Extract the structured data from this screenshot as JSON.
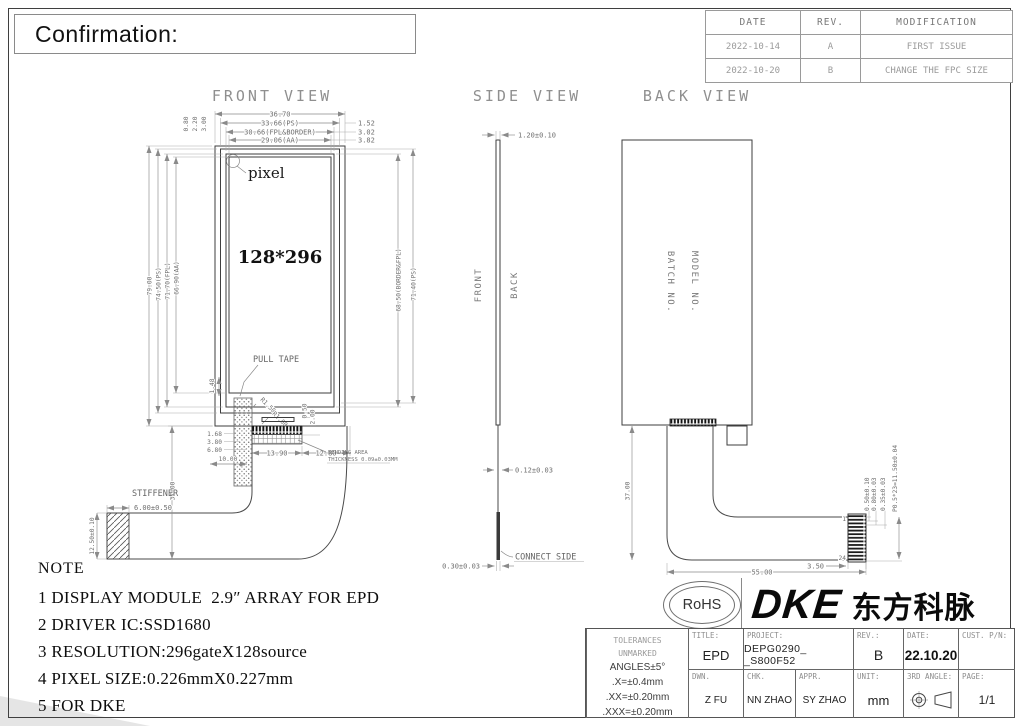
{
  "confirmation": {
    "label": "Confirmation:"
  },
  "revision": {
    "headers": [
      "DATE",
      "REV.",
      "MODIFICATION"
    ],
    "rows": [
      [
        "2022-10-14",
        "A",
        "FIRST ISSUE"
      ],
      [
        "2022-10-20",
        "B",
        "CHANGE THE FPC SIZE"
      ]
    ]
  },
  "front": {
    "title": "FRONT VIEW",
    "labels": {
      "pixel": "pixel",
      "resolution": "128*296",
      "pull_tape": "PULL TAPE",
      "stiffener": "STIFFENER",
      "bending_1": "BENDING AREA",
      "bending_2": "THICKNESS 0.09±0.03MM"
    },
    "dims": {
      "width_overall": "36.70",
      "width_ps": "33.66(PS)",
      "width_fpl": "30.66(FPL&BORDER)",
      "width_aa": "29.06(AA)",
      "right_gap_ps": "1.52",
      "right_gap_fpl": "3.02",
      "right_gap_aa": "3.82",
      "top_gap_ps": "0.80",
      "top_gap_fpl": "2.20",
      "top_gap_aa": "3.00",
      "height_overall": "79.00",
      "height_ps": "74.50(PS)",
      "height_fpl": "71.70(FPL)",
      "height_aa": "66.90(AA)",
      "height_border_fpl": "68.50(BORDER&FPL)",
      "height_ps_right": "71.40(PS)",
      "tape_gap": "1.48",
      "stack_1": "1.68",
      "stack_2": "3.80",
      "stack_3": "6.80",
      "tape_width": "10.00",
      "conn_width": "13.90",
      "conn_right": "12.80",
      "conn_h1": "0.50",
      "conn_h2": "2.00",
      "radius_1": "R1.50",
      "radius_2": "R1.00",
      "fpc_drop": "37.00",
      "stiffener_w": "6.00±0.50",
      "stiffener_h": "12.50±0.10"
    }
  },
  "side": {
    "title": "SIDE VIEW",
    "front_label": "FRONT",
    "back_label": "BACK",
    "connect_side": "CONNECT SIDE",
    "dims": {
      "thickness": "1.20±0.10",
      "fpc_thickness": "0.12±0.03",
      "connector_thickness": "0.30±0.03"
    }
  },
  "back": {
    "title": "BACK VIEW",
    "model_no": "MODEL NO.",
    "batch_no": "BATCH NO.",
    "pin_first": "1",
    "pin_last": "24",
    "dims": {
      "fpc_drop": "37.00",
      "fpc_length": "55.00",
      "connector_offset": "3.50",
      "pin_dim_1": "0.50±0.10",
      "pin_dim_2": "0.80±0.03",
      "pin_dim_3": "0.35±0.03",
      "pin_pitch": "P0.5*23=11.50±0.04"
    }
  },
  "note": {
    "heading": "NOTE",
    "lines": [
      "1 DISPLAY MODULE  2.9″ ARRAY FOR EPD",
      "2 DRIVER IC:SSD1680",
      "3 RESOLUTION:296gateX128source",
      "4 PIXEL SIZE:0.226mmX0.227mm",
      "5 FOR DKE"
    ]
  },
  "logos": {
    "rohs": "RoHS",
    "dke": "DKE",
    "dke_cn": "东方科脉"
  },
  "title_block": {
    "tolerances": [
      "TOLERANCES",
      "UNMARKED",
      "ANGLES±5°",
      ".X=±0.4mm",
      ".XX=±0.20mm",
      ".XXX=±0.20mm"
    ],
    "title_label": "TITLE:",
    "title_value": "EPD",
    "project_label": "PROJECT:",
    "project_value": "DEPG0290_ _S800F52",
    "rev_label": "REV.:",
    "rev_value": "B",
    "date_label": "DATE:",
    "date_value": "22.10.20",
    "cust_label": "CUST. P/N:",
    "cust_value": "",
    "dwn_label": "DWN.",
    "dwn_value": "Z FU",
    "chk_label": "CHK.",
    "chk_value": "NN ZHAO",
    "appr_label": "APPR.",
    "appr_value": "SY ZHAO",
    "unit_label": "UNIT:",
    "unit_value": "mm",
    "angle_label": "3RD ANGLE:",
    "page_label": "PAGE:",
    "page_value": "1/1"
  }
}
